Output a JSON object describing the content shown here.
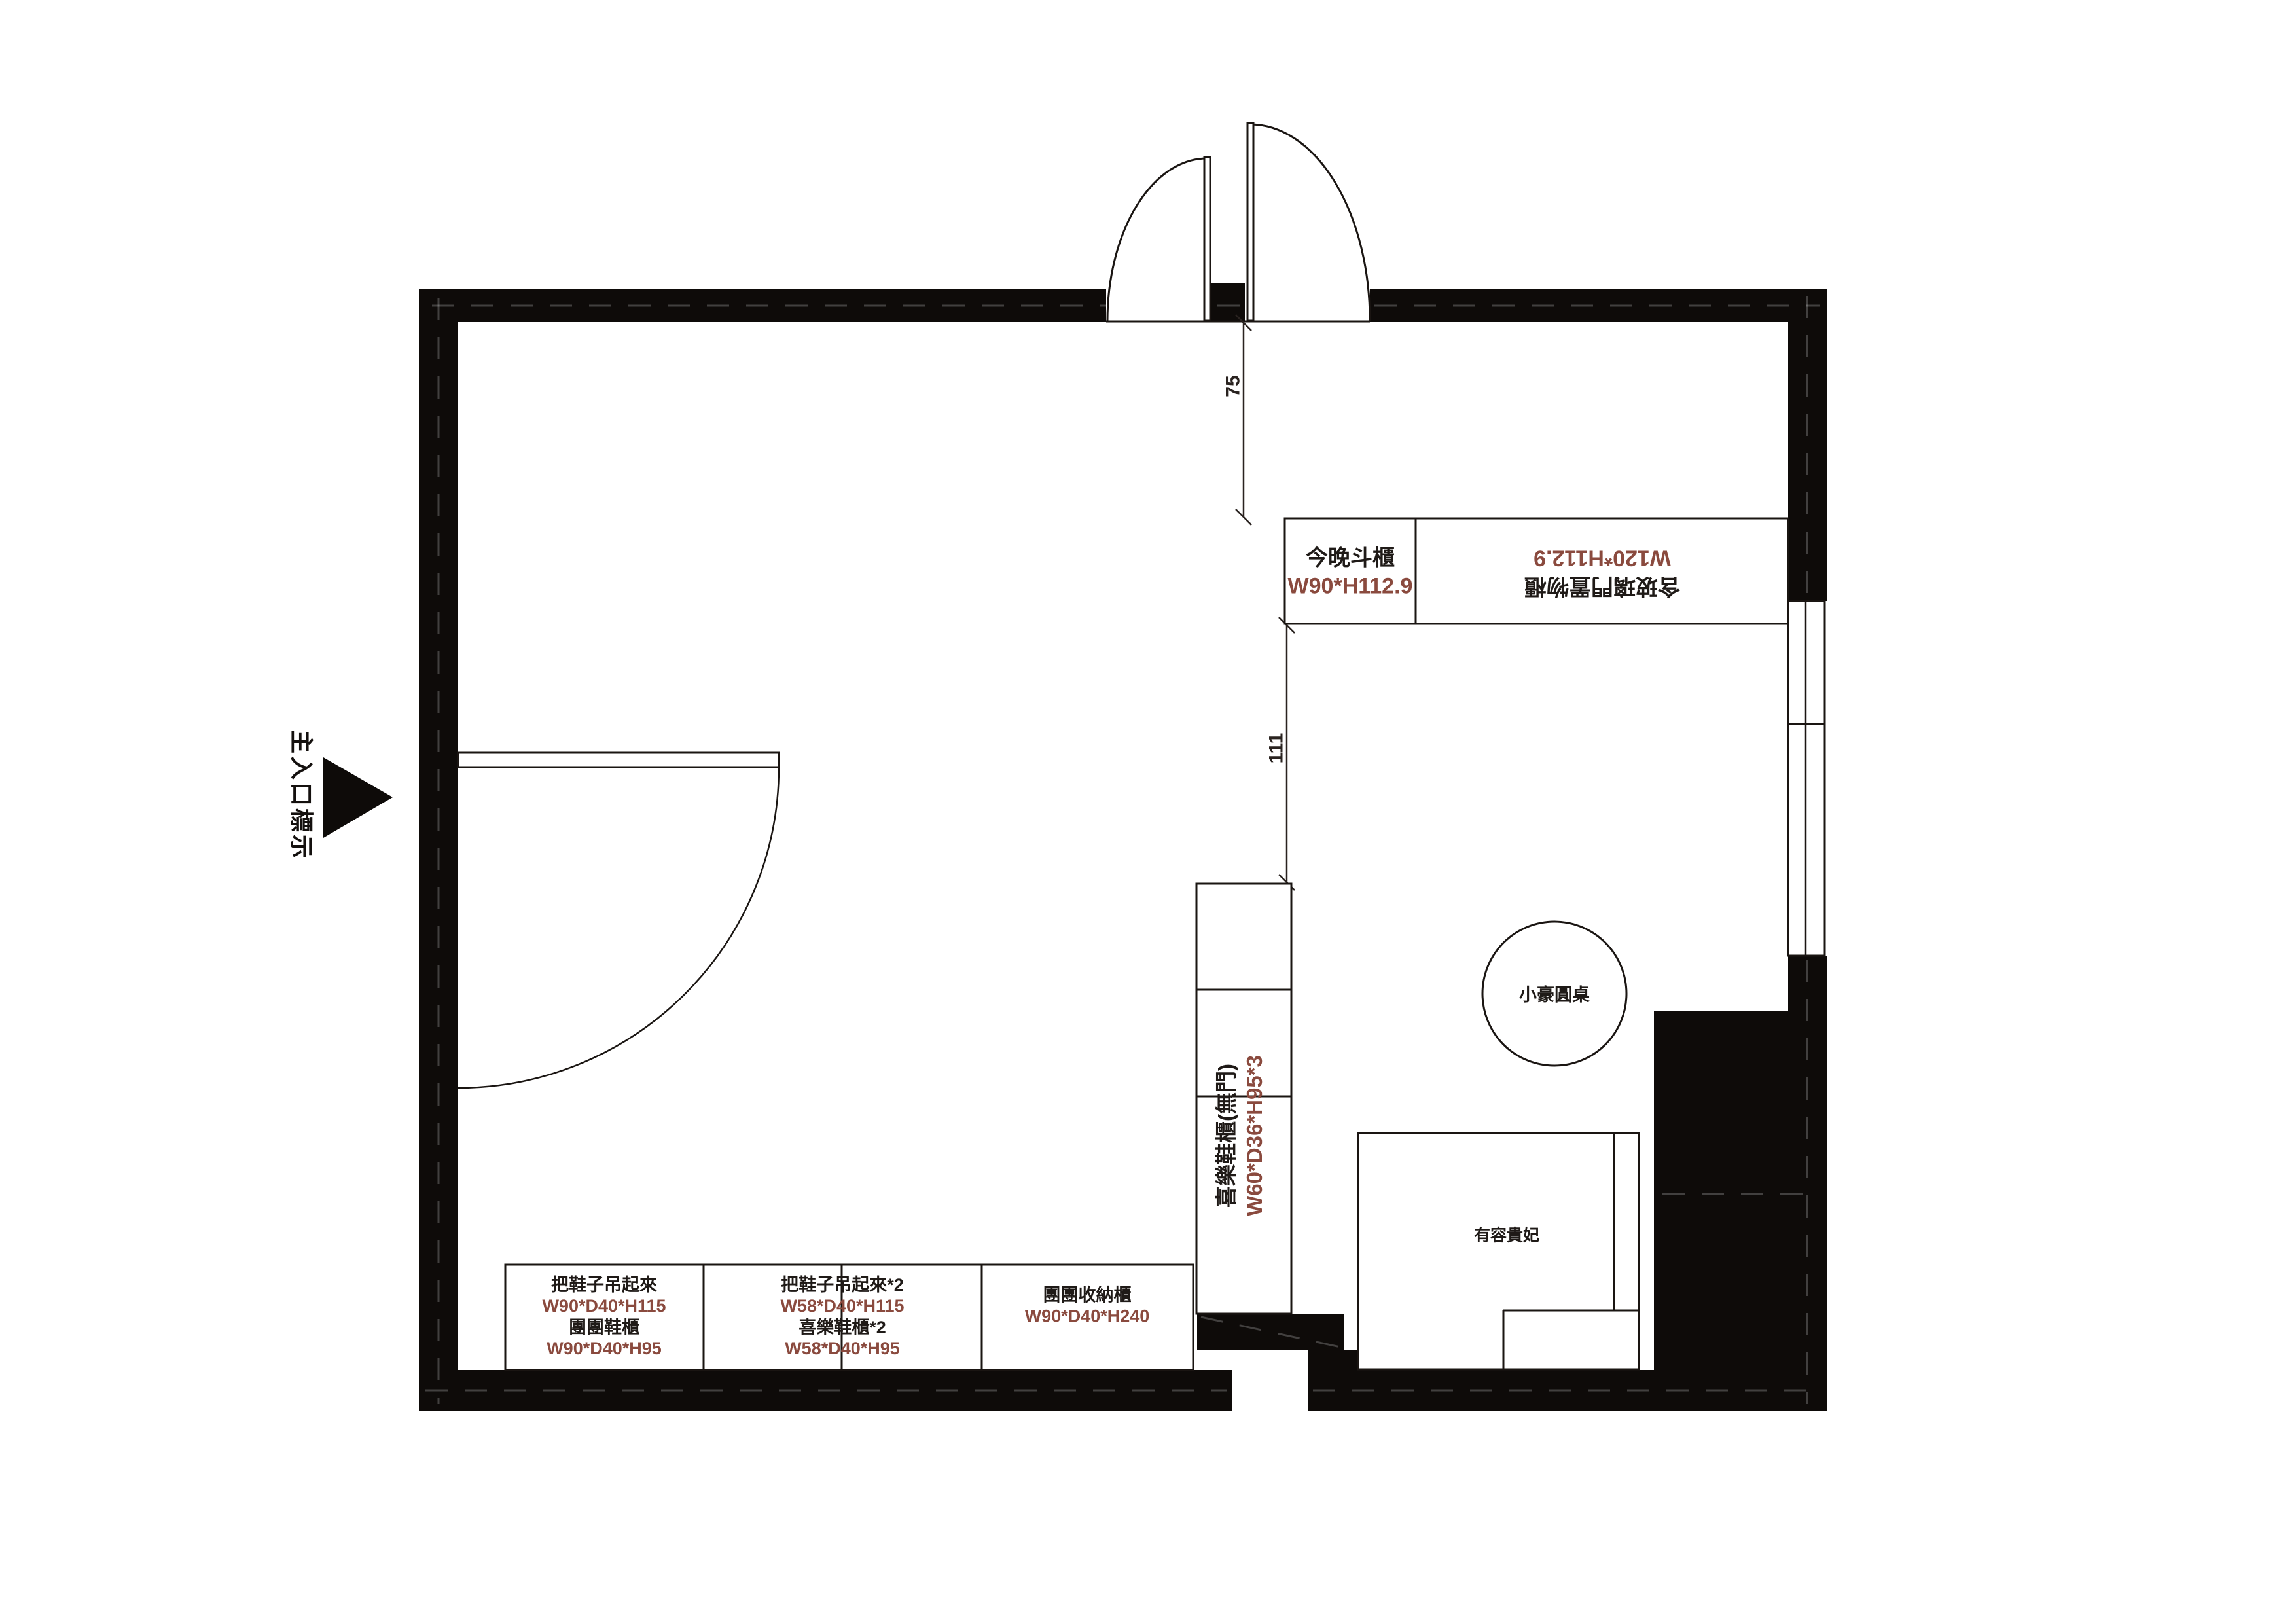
{
  "plan": {
    "entrance_label": "主入口標示",
    "dims": {
      "door_offset": "75",
      "cabinet_gap": "111"
    },
    "top_cabinets": {
      "chest": {
        "name": "今晚斗櫃",
        "size": "W90*H112.9"
      },
      "sideboard": {
        "name": "含玻璃門置物櫃",
        "size": "W120*H112.9"
      }
    },
    "tall_shoe_cabinet": {
      "name": "喜樂鞋櫃(無門)",
      "size": "W60*D36*H95*3"
    },
    "bottom_cabinets": [
      {
        "line1": "把鞋子吊起來",
        "line2": "W90*D40*H115",
        "line3": "團團鞋櫃",
        "line4": "W90*D40*H95"
      },
      {
        "line1": "把鞋子吊起來*2",
        "line2": "W58*D40*H115",
        "line3": "喜樂鞋櫃*2",
        "line4": "W58*D40*H95"
      },
      {
        "line1": "團團收納櫃",
        "line2": "W90*D40*H240"
      }
    ],
    "round_table_label": "小豪圓桌",
    "chaise_label": "有容貴妃",
    "colors": {
      "wall": "#0e0b09",
      "line": "#1a1512",
      "dim_text": "#8a4a3e",
      "label_text": "#1f1a17"
    }
  }
}
